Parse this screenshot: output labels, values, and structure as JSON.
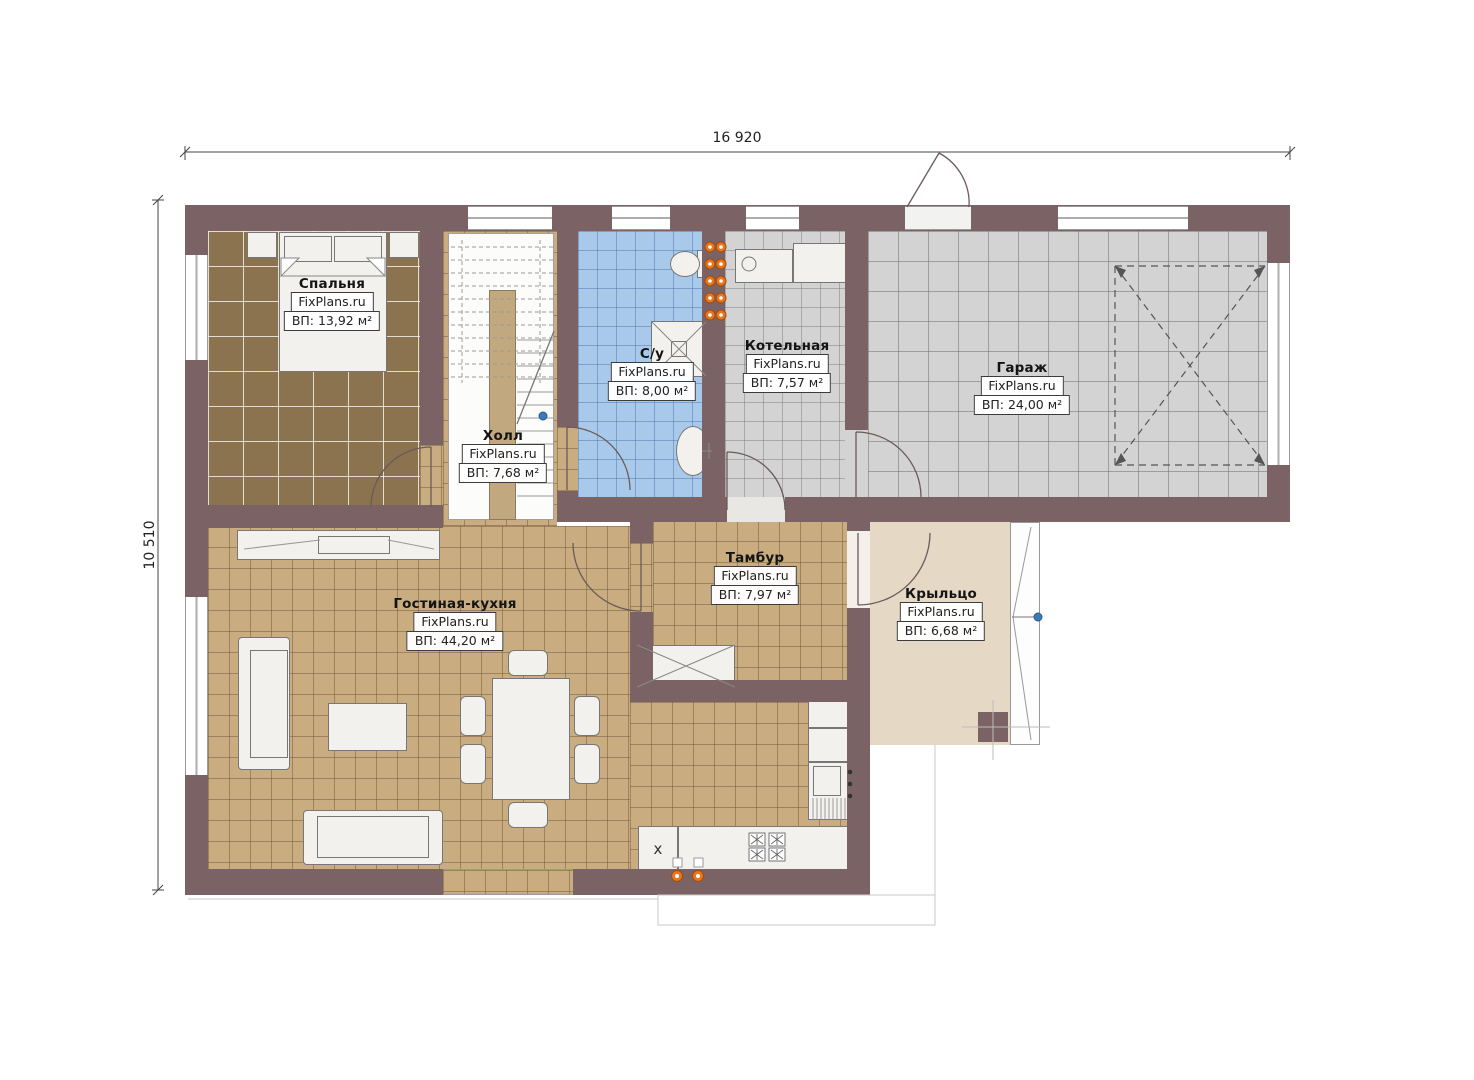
{
  "plan": {
    "watermark": "FixPlans.ru",
    "dimensions": {
      "width_label": "16 920",
      "height_label": "10 510"
    },
    "rooms": [
      {
        "id": "bedroom",
        "name": "Спальня",
        "area": "ВП: 13,92 м²"
      },
      {
        "id": "hall",
        "name": "Холл",
        "area": "ВП: 7,68 м²"
      },
      {
        "id": "bathroom",
        "name": "С/у",
        "area": "ВП: 8,00 м²"
      },
      {
        "id": "boiler",
        "name": "Котельная",
        "area": "ВП: 7,57 м²"
      },
      {
        "id": "garage",
        "name": "Гараж",
        "area": "ВП: 24,00 м²"
      },
      {
        "id": "vestibule",
        "name": "Тамбур",
        "area": "ВП: 7,97 м²"
      },
      {
        "id": "living",
        "name": "Гостиная-кухня",
        "area": "ВП: 44,20 м²"
      },
      {
        "id": "porch",
        "name": "Крыльцо",
        "area": "ВП: 6,68 м²"
      }
    ],
    "symbols": {
      "cabinet_mark": "x"
    },
    "colors": {
      "wall": "#7b6365",
      "floor_tan": "#c9ad81",
      "floor_bedroom": "#8b7350",
      "floor_bath": "#a9c9eb",
      "floor_gray": "#d3d3d3",
      "floor_porch": "#e5d9c6",
      "radiator": "#e8761f",
      "marker_blue": "#3b7ab8"
    }
  }
}
